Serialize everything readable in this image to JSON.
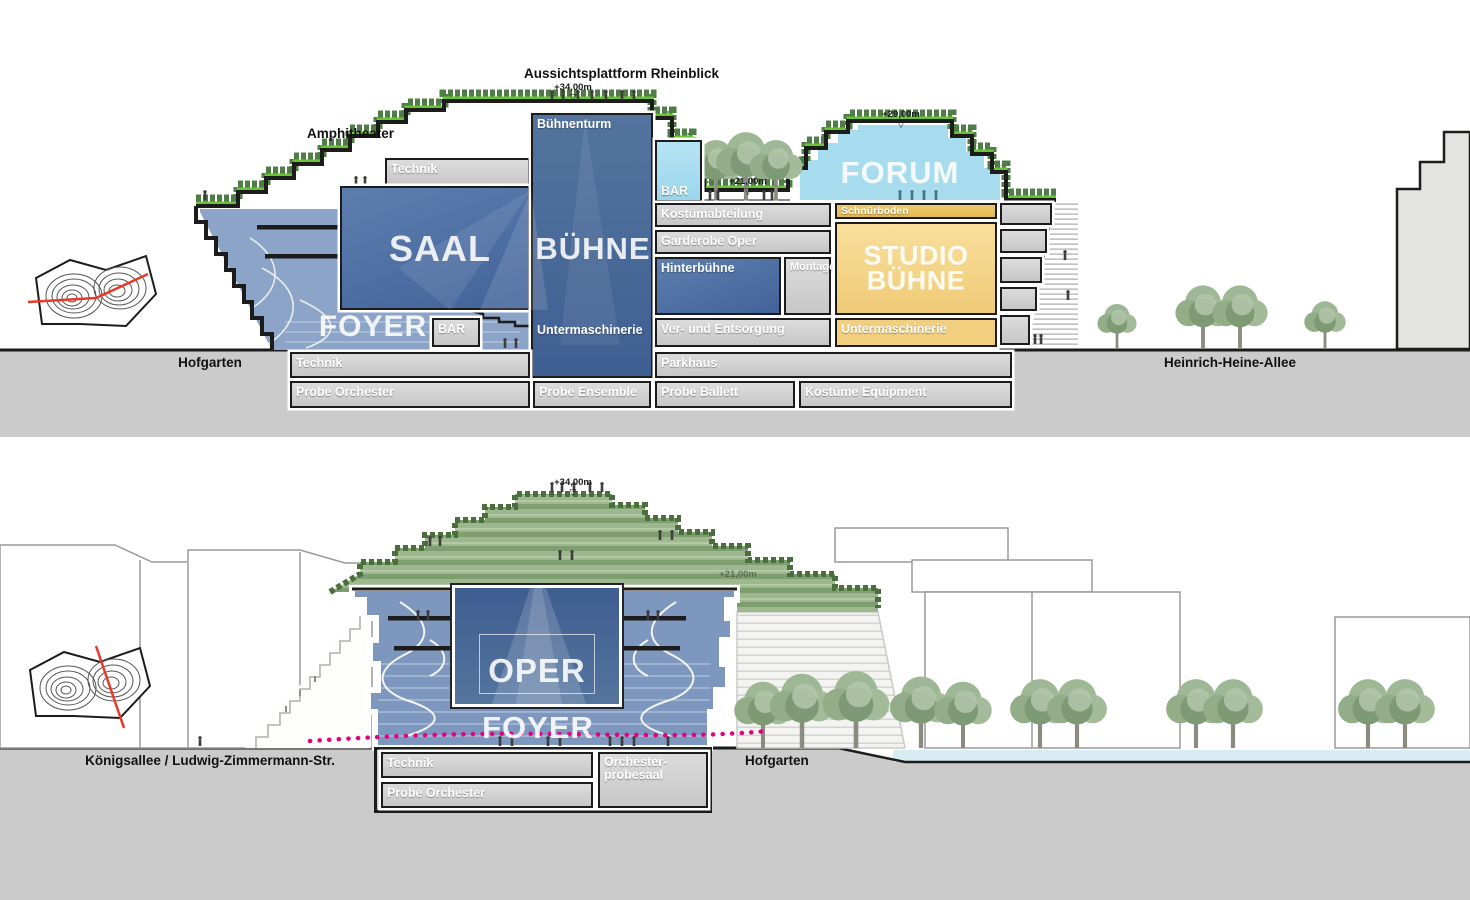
{
  "title": "Opera house sections",
  "top": {
    "amphitheater": "Amphitheater",
    "plattform": "Aussichtsplattform Rheinblick",
    "lvl34": "+34,00m",
    "lvl29": "+29,00m",
    "lvl21": "+21,00m",
    "ground_left": "Hofgarten",
    "ground_right": "Heinrich-Heine-Allee",
    "buehnenturm": "Bühnenturm",
    "technik_roof": "Technik",
    "saal": "SAAL",
    "buehne": "BÜHNE",
    "foyer": "FOYER",
    "bar_foyer": "BAR",
    "bar_terrace": "BAR",
    "untermaschinerie_turm": "Untermaschinerie",
    "forum": "FORUM",
    "kostuemabteilung": "Kostümabteilung",
    "schnuerboden": "Schnürboden",
    "garderobe_oper": "Garderobe Oper",
    "hinterbuehne": "Hinterbühne",
    "montage": "Montage",
    "studio_line1": "STUDIO",
    "studio_line2": "BÜHNE",
    "ver_und_entsorgung": "Ver- und Entsorgung",
    "untermaschinerie_studio": "Untermaschinerie",
    "technik_keller": "Technik",
    "parkhaus": "Parkhaus",
    "probe_orchester": "Probe Orchester",
    "probe_ensemble": "Probe Ensemble",
    "probe_ballett": "Probe Ballett",
    "kostueme_equipment": "Kostüme Equipment"
  },
  "bottom": {
    "lvl34": "+34,00m",
    "lvl21": "+21,00m",
    "ground_left": "Königsallee / Ludwig-Zimmermann-Str.",
    "ground_right": "Hofgarten",
    "oper": "OPER",
    "foyer": "FOYER",
    "technik": "Technik",
    "probe_orchester": "Probe Orchester",
    "orchester_line1": "Orchester-",
    "orchester_line2": "probesaal"
  },
  "colors": {
    "main_blue": "#4a6b9d",
    "light_blue_foyer": "#8ba4c7",
    "bottom_blue": "#7e97bf",
    "cyan": "#a7dbee",
    "yellow": "#f6d88e",
    "room_gray": "#d3d3d3",
    "ground_gray": "#cbcbcb",
    "green_edge": "#6cc235",
    "vegetation": "#4f7d46",
    "water": "#d8ecf4",
    "section_line_pink": "#e5007d",
    "site_cut_red": "#e8392a",
    "outline": "#1c1c1c"
  }
}
